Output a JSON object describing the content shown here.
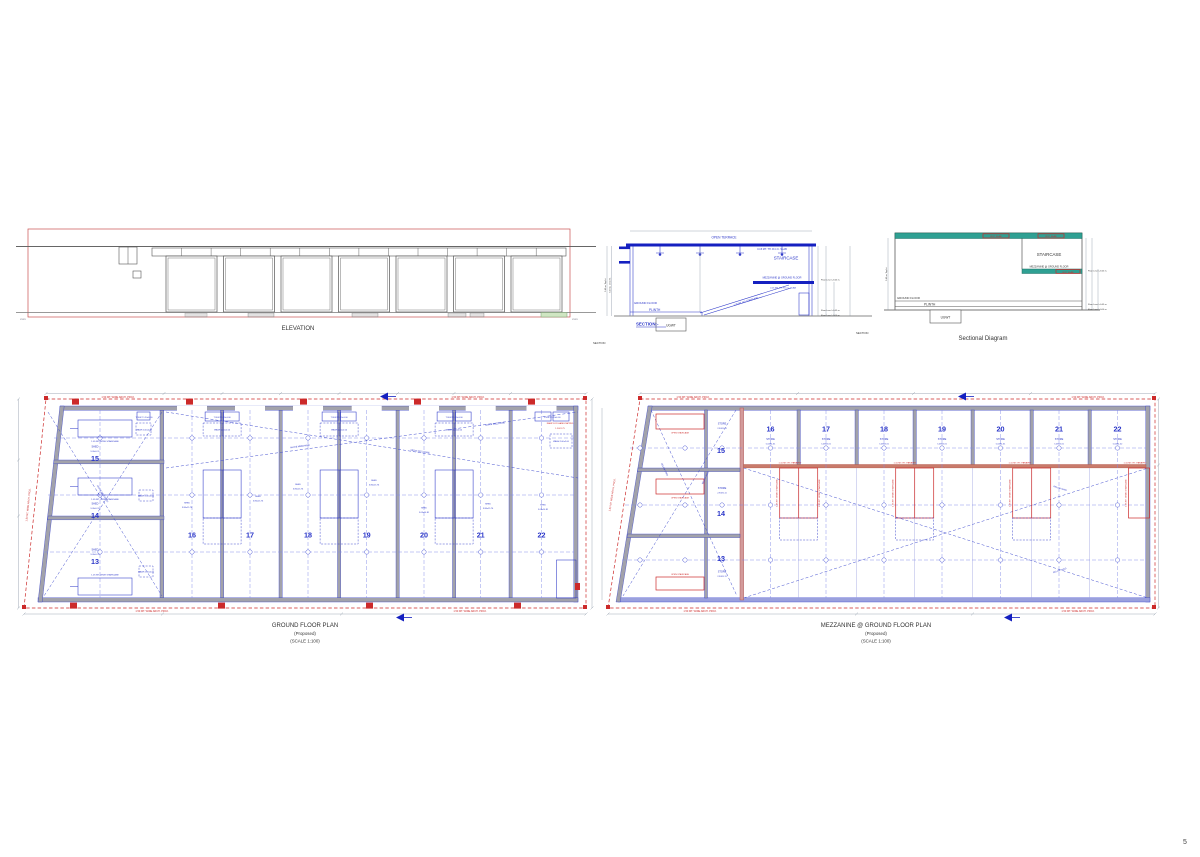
{
  "page_number": "5",
  "elevation": {
    "title": "ELEVATION",
    "left_tick": "XXXX",
    "right_tick": "XXXX"
  },
  "section": {
    "heading": "SECTION:-",
    "footnote": "SECTION",
    "open_terrace": "OPEN TERRACE",
    "rcc_slab": "0.15 MT. TH. R.C.C. SLAB",
    "staircase": "STAIRCASE",
    "stair_note": "1.05 MT. WD STAIRCASE",
    "mezzanine": "MEZZANINE @ GROUND FLOOR",
    "ground_floor": "GROUND FLOOR",
    "plinth": "PLINTH",
    "ugwt": "UGWT",
    "ht_total": "5.65 m. Top ht.",
    "ht_clear": "5.20 m. Clear ht.",
    "level_mezz": "Floor Level +3.65 m.",
    "level_plinth": "Floor Level +0.45 m.",
    "level_ground": "Floor Level +0.00 m."
  },
  "sectional_diagram": {
    "title": "Sectional Diagram",
    "footnote": "SECTION",
    "staircase": "STAIRCASE",
    "mezzanine": "MEZZANINE @ GROUND FLOOR",
    "ground_floor": "GROUND FLOOR",
    "plinth": "PLINTH",
    "ugwt": "UGWT",
    "slab_tag": "RCC SLAB",
    "ht_total": "5.65 m. Top ht.",
    "level_mezz": "Floor Level +3.65 m.",
    "level_plinth": "Floor Level +0.45 m.",
    "level_ground": "Floor Level +0.00 m."
  },
  "ground_plan": {
    "title": "GROUND FLOOR PLAN",
    "subtitle": "(Proposed)",
    "scale": "(SCALE 1:100)",
    "arch_proj": "1.50 MT. WIDE ARCH. PROJ.",
    "above_mezz": "ABOVE MEZZANINE",
    "stair_note": "1.05 MT. WIDE STAIRCASE",
    "toilet": "TOILET 1.20x1.00",
    "wash": "WASH 2.00x2.00",
    "ramp_line1": "RAMP FOR HANDICAPPED",
    "ramp_line2": "1.50X1.75",
    "left_units": [
      {
        "num": "15",
        "type": "SHED",
        "dims": "9.09x5.11"
      },
      {
        "num": "14",
        "type": "SHED",
        "dims": "9.09x5.11"
      },
      {
        "num": "13",
        "type": "SHED",
        "dims": "9.09x5.11"
      }
    ],
    "bays": [
      {
        "num": "16",
        "type": "SHED",
        "dims": "3.86x15.76"
      },
      {
        "num": "17",
        "type": "SHED",
        "dims": "3.86x15.76"
      },
      {
        "num": "18",
        "type": "SHED",
        "dims": "3.86x15.76"
      },
      {
        "num": "19",
        "type": "SHED",
        "dims": "3.86x15.76"
      },
      {
        "num": "20",
        "type": "SHED",
        "dims": "5.03x14.81"
      },
      {
        "num": "21",
        "type": "SHED",
        "dims": "3.86x15.76"
      },
      {
        "num": "22",
        "type": "SHED",
        "dims": "5.03x14.81"
      }
    ]
  },
  "mezzanine_plan": {
    "title": "MEZZANINE @ GROUND FLOOR PLAN",
    "subtitle": "(Proposed)",
    "scale": "(SCALE 1:100)",
    "arch_proj": "1.50 MT. WIDE ARCH. PROJ.",
    "below_shed": "BELOW SHED",
    "parapet": "1.10 MT. HT. PARAPET",
    "open_staircase": "OPEN STAIRCASE",
    "stair_note": "1.05 MT. WIDE STAIRCASE",
    "left_units": [
      {
        "num": "15",
        "type": "STORE",
        "dims": "2.90X5.11"
      },
      {
        "num": "14",
        "type": "STORE",
        "dims": "2.90X5.11"
      },
      {
        "num": "13",
        "type": "STORE",
        "dims": "2.90X5.11"
      }
    ],
    "bays": [
      {
        "num": "16",
        "type": "STORE",
        "dims": "5.03X4.31"
      },
      {
        "num": "17",
        "type": "STORE",
        "dims": "5.03X4.31"
      },
      {
        "num": "18",
        "type": "STORE",
        "dims": "5.03X4.31"
      },
      {
        "num": "19",
        "type": "STORE",
        "dims": "5.03X4.31"
      },
      {
        "num": "20",
        "type": "STORE",
        "dims": "5.03X4.31"
      },
      {
        "num": "21",
        "type": "STORE",
        "dims": "5.03X4.31"
      },
      {
        "num": "22",
        "type": "STORE",
        "dims": "5.03X4.52"
      }
    ]
  }
}
